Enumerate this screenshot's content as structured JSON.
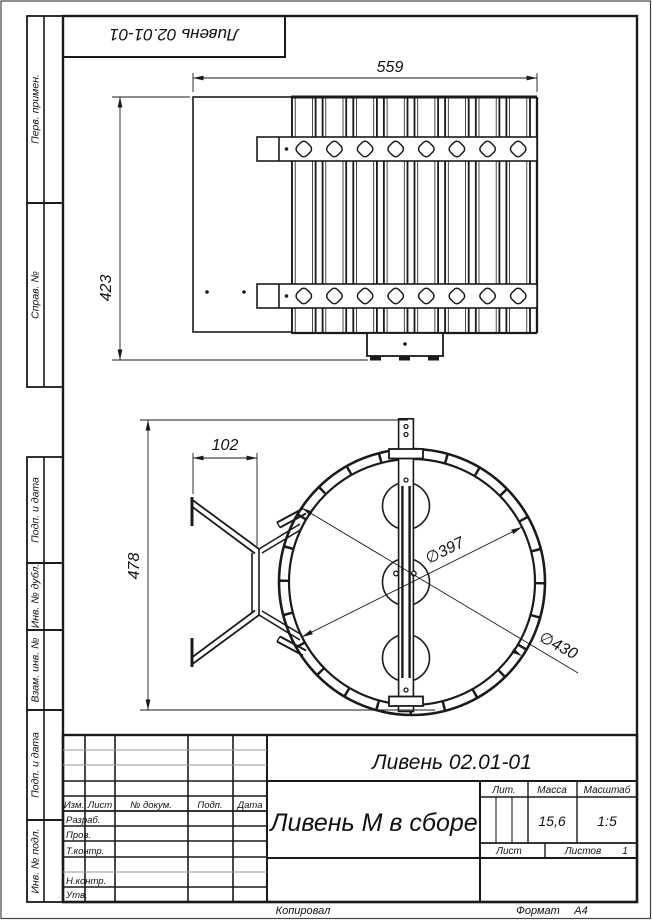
{
  "page": {
    "copied": "Копировал",
    "format_label": "Формат",
    "format_value": "А4"
  },
  "top_stamp": {
    "designation": "Ливень  02.01-01"
  },
  "margin": {
    "labels": {
      "perv_primen": "Перв. примен.",
      "sprav_no": "Справ. №",
      "podp_data_1": "Подп. и дата",
      "inv_dubl": "Инв. № дубл.",
      "vzam_inv": "Взам. инв. №",
      "podp_data_2": "Подп. и дата",
      "inv_podl": "Инв. № подл."
    }
  },
  "drawing": {
    "front_view": {
      "dim_width": "559",
      "dim_height": "423"
    },
    "side_view": {
      "dim_offset": "102",
      "dim_height": "478",
      "dim_inner_diameter": "∅397",
      "dim_outer_diameter": "∅430"
    }
  },
  "title_block": {
    "designation": "Ливень  02.01-01",
    "part_name": "Ливень М в сборе",
    "columns": {
      "izm": "Изм.",
      "list": "Лист",
      "dokum": "№ докум.",
      "podp": "Подп.",
      "data": "Дата"
    },
    "rows": {
      "razrab": "Разраб.",
      "prov": "Пров.",
      "t_kontr": "Т.контр.",
      "n_kontr": "Н.контр.",
      "utv": "Утв."
    },
    "lit_label": "Лит.",
    "massa_label": "Масса",
    "masshtab_label": "Масштаб",
    "massa_value": "15,6",
    "masshtab_value": "1:5",
    "list_label": "Лист",
    "listov_label": "Листов",
    "listov_value": "1"
  }
}
